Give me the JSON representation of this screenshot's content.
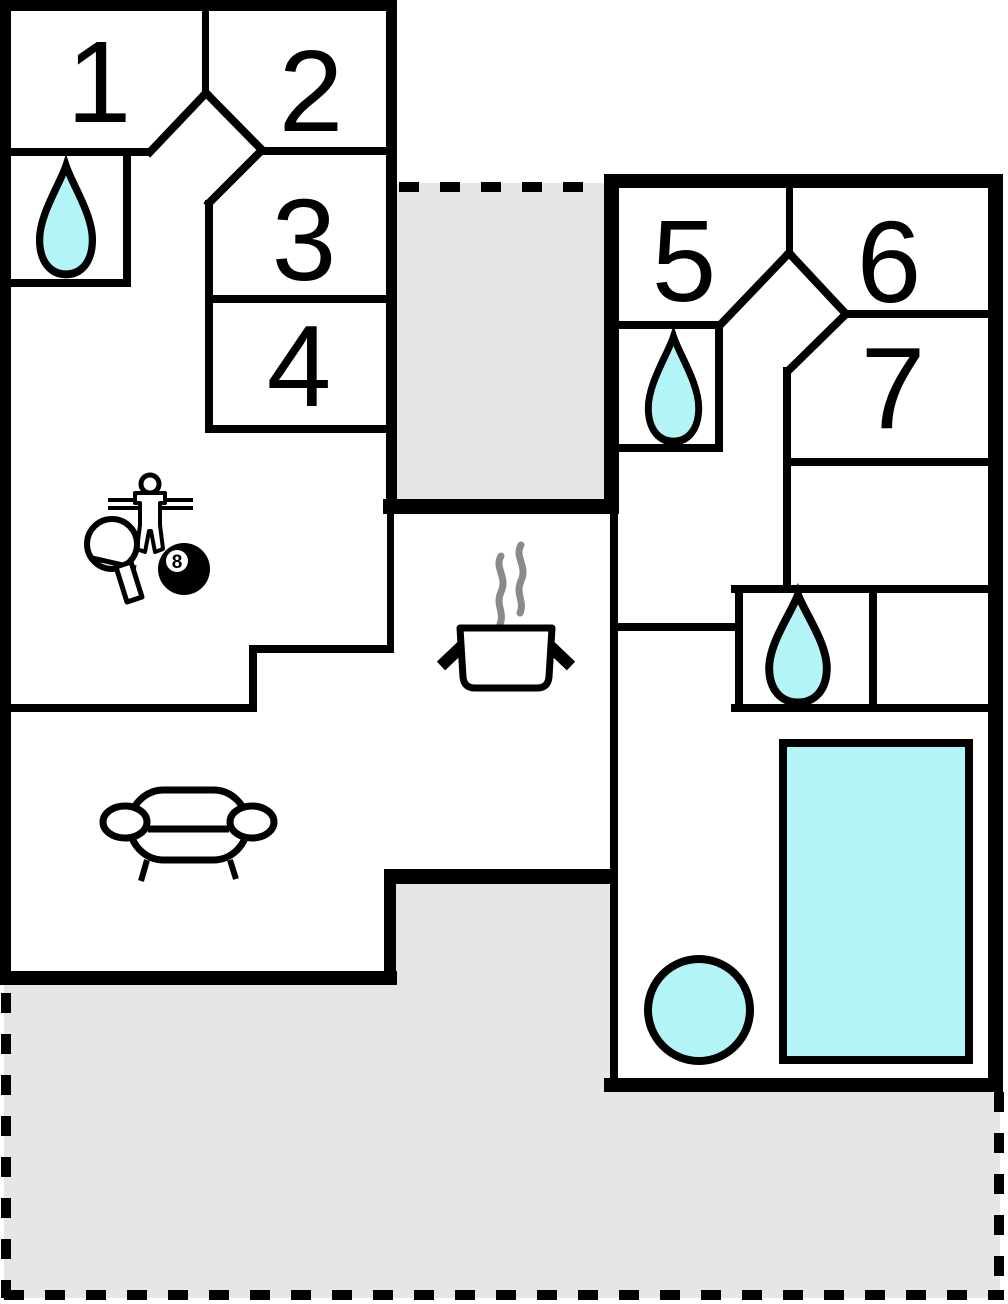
{
  "plan": {
    "title": "Holiday home floor plan",
    "rooms": [
      {
        "number": "1"
      },
      {
        "number": "2"
      },
      {
        "number": "3"
      },
      {
        "number": "4"
      },
      {
        "number": "5"
      },
      {
        "number": "6"
      },
      {
        "number": "7"
      }
    ],
    "billiards": {
      "label": "8"
    },
    "features": {
      "bathroom_icon": "water-drop",
      "kitchen_icon": "cooking-pot-with-steam",
      "living_room_icon": "sofa",
      "game_room_icons": [
        "foosball-player",
        "table-tennis-paddle",
        "billiard-8-ball"
      ],
      "pool_room_icons": [
        "round-tub",
        "rectangular-pool"
      ],
      "outdoor_areas": [
        "top-terrace",
        "bottom-terrace"
      ]
    },
    "colors": {
      "wall": "#000000",
      "floor": "#ffffff",
      "terrace": "#e6e6e6",
      "water": "#b3f5f7",
      "steam": "#8a8a8a"
    }
  }
}
